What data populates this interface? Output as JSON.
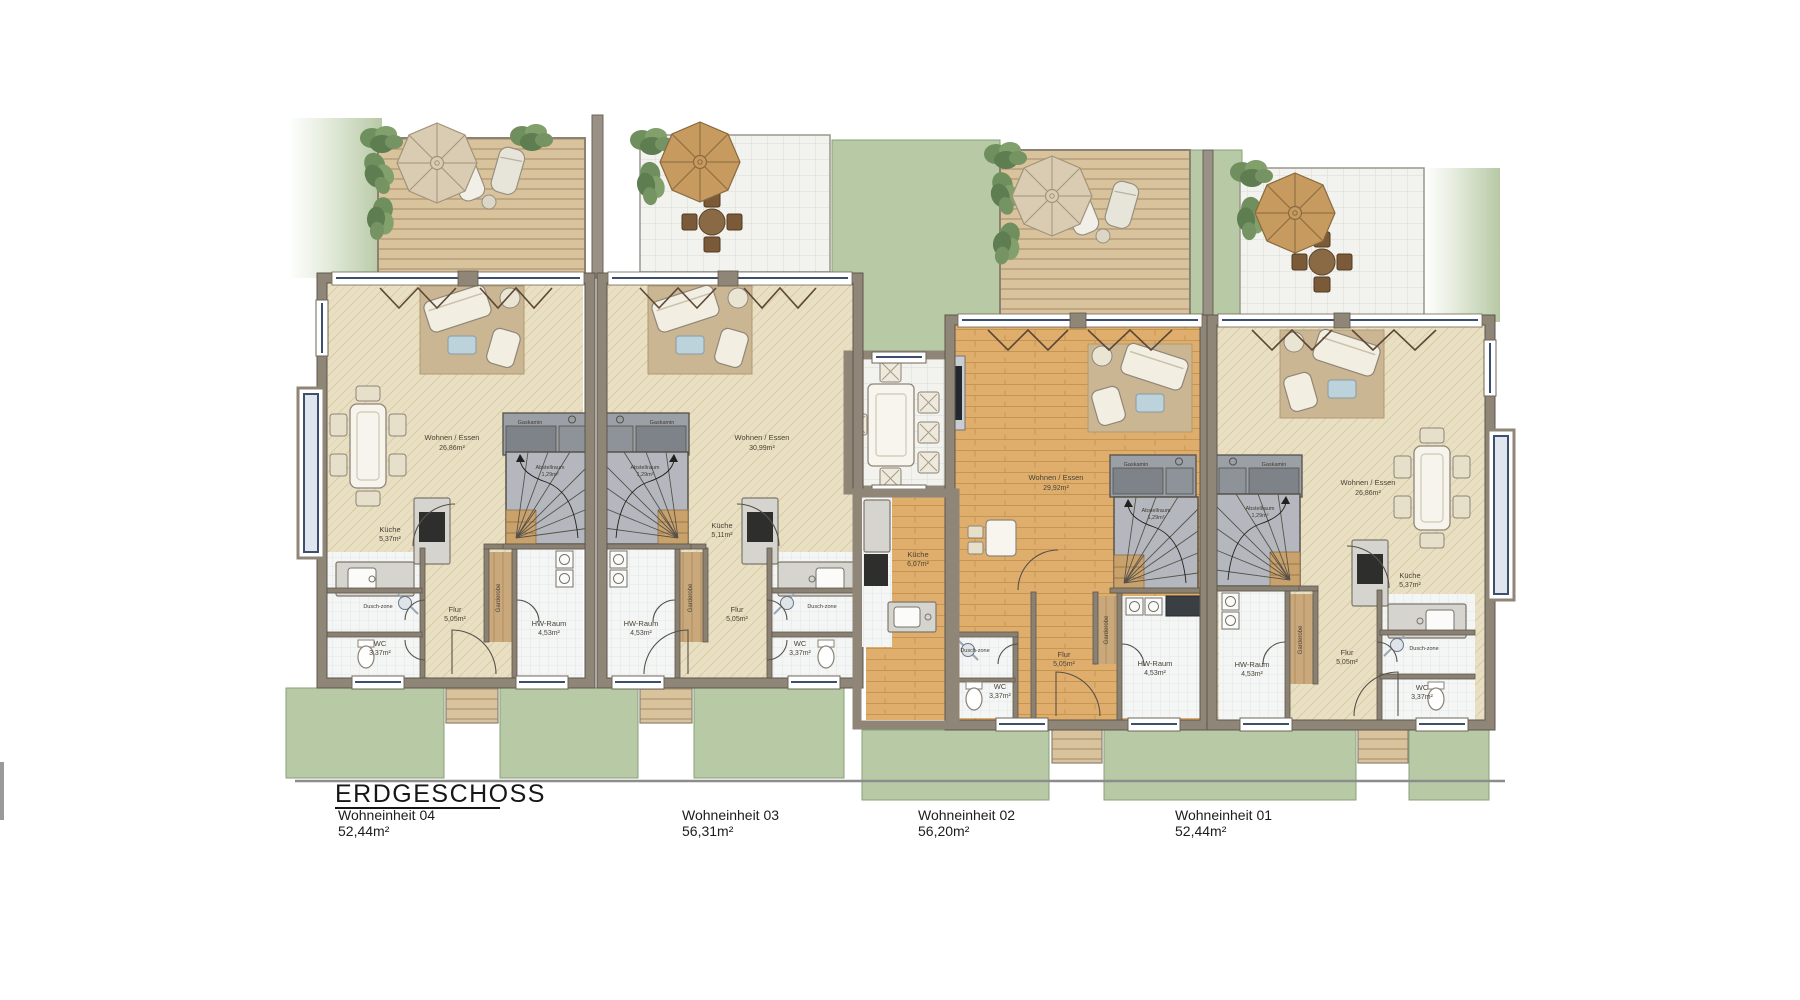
{
  "meta": {
    "drawing_type": "floor-plan",
    "floor": "ground floor"
  },
  "palette": {
    "lawn": "#b7c9a5",
    "lawn_edge": "#8aa07c",
    "deck_light": "#d9c39c",
    "deck_dark": "#bfa783",
    "tile_white": "#f2f2ef",
    "wall": "#8f8677",
    "wall_edge": "#5d574d",
    "floor_cream": "#e9dfc3",
    "floor_orange": "#dfae6d",
    "wood_strip": "#c9a87c",
    "window_blue": "#3c4f6e",
    "hedge_green": "#6f8f5f",
    "stair_gray": "#b4b8be",
    "fireplace_gray": "#9aa0a6",
    "rug_tan": "#cbb694"
  },
  "footer": {
    "title": "ERDGESCHOSS",
    "units": [
      {
        "name": "Wohneinheit 04",
        "area": "52,44m²"
      },
      {
        "name": "Wohneinheit 03",
        "area": "56,31m²"
      },
      {
        "name": "Wohneinheit 02",
        "area": "56,20m²"
      },
      {
        "name": "Wohneinheit 01",
        "area": "52,44m²"
      }
    ]
  },
  "units": {
    "u04": {
      "rooms": {
        "wohnen": {
          "label": "Wohnen / Essen",
          "area": "26,86m²"
        },
        "kueche": {
          "label": "Küche",
          "area": "5,37m²"
        },
        "flur": {
          "label": "Flur",
          "area": "5,05m²"
        },
        "wc": {
          "label": "WC",
          "area": "3,37m²"
        },
        "hw": {
          "label": "HW-Raum",
          "area": "4,53m²"
        },
        "dusch": {
          "label": "Dusch-zone"
        },
        "garderobe": {
          "label": "Garderobe"
        },
        "gaskamin": {
          "label": "Gaskamin"
        },
        "abstell": {
          "label": "Abstellraum",
          "area": "1,29m²"
        }
      }
    },
    "u03": {
      "rooms": {
        "wohnen": {
          "label": "Wohnen / Essen",
          "area": "30,99m²"
        },
        "kueche": {
          "label": "Küche",
          "area": "5,11m²"
        },
        "flur": {
          "label": "Flur",
          "area": "5,05m²"
        },
        "wc": {
          "label": "WC",
          "area": "3,37m²"
        },
        "hw": {
          "label": "HW-Raum",
          "area": "4,53m²"
        },
        "dusch": {
          "label": "Dusch-zone"
        },
        "garderobe": {
          "label": "Garderobe"
        },
        "gaskamin": {
          "label": "Gaskamin"
        },
        "abstell": {
          "label": "Abstellraum",
          "area": "1,29m²"
        }
      }
    },
    "u02": {
      "rooms": {
        "wohnen": {
          "label": "Wohnen / Essen",
          "area": "29,92m²"
        },
        "kueche": {
          "label": "Küche",
          "area": "6,07m²"
        },
        "flur": {
          "label": "Flur",
          "area": "5,05m²"
        },
        "wc": {
          "label": "WC",
          "area": "3,37m²"
        },
        "hw": {
          "label": "HW-Raum",
          "area": "4,53m²"
        },
        "dusch": {
          "label": "Dusch-zone"
        },
        "garderobe": {
          "label": "Garderobe"
        },
        "gaskamin": {
          "label": "Gaskamin"
        },
        "abstell": {
          "label": "Abstellraum",
          "area": "1,29m²"
        }
      }
    },
    "u01": {
      "rooms": {
        "wohnen": {
          "label": "Wohnen / Essen",
          "area": "26,86m²"
        },
        "kueche": {
          "label": "Küche",
          "area": "5,37m²"
        },
        "flur": {
          "label": "Flur",
          "area": "5,05m²"
        },
        "wc": {
          "label": "WC",
          "area": "3,37m²"
        },
        "hw": {
          "label": "HW-Raum",
          "area": "4,53m²"
        },
        "dusch": {
          "label": "Dusch-zone"
        },
        "garderobe": {
          "label": "Garderobe"
        },
        "gaskamin": {
          "label": "Gaskamin"
        },
        "abstell": {
          "label": "Abstellraum",
          "area": "1,29m²"
        }
      }
    }
  }
}
